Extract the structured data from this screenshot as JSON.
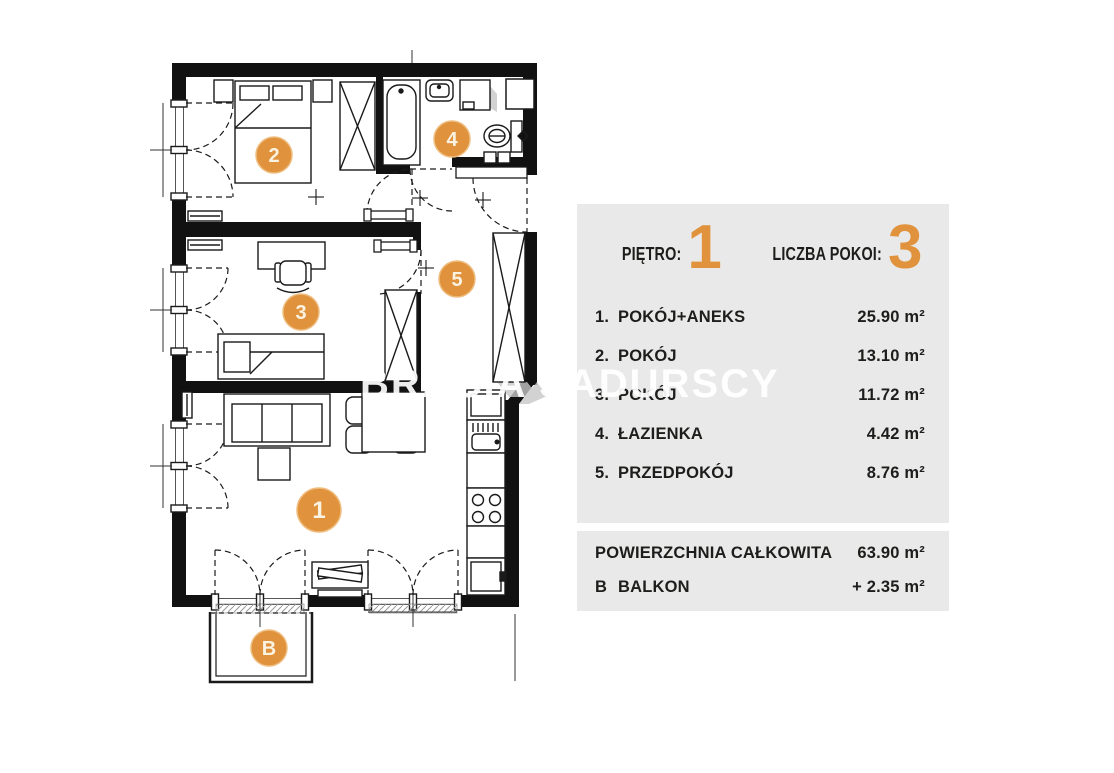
{
  "accent": "#e0923c",
  "panel_bg": "#e9e9e9",
  "watermark": "BRACIA SADURSCY",
  "header": {
    "floor_label": "PIĘTRO:",
    "floor_value": "1",
    "rooms_label": "LICZBA POKOI:",
    "rooms_value": "3"
  },
  "rooms": [
    {
      "num": "1.",
      "name": "POKÓJ+ANEKS",
      "area": "25.90 m²"
    },
    {
      "num": "2.",
      "name": "POKÓJ",
      "area": "13.10 m²"
    },
    {
      "num": "3.",
      "name": "POKÓJ",
      "area": "11.72 m²"
    },
    {
      "num": "4.",
      "name": "ŁAZIENKA",
      "area": "4.42 m²"
    },
    {
      "num": "5.",
      "name": "PRZEDPOKÓJ",
      "area": "8.76 m²"
    }
  ],
  "summary": {
    "total_label": "POWIERZCHNIA CAŁKOWITA",
    "total_value": "63.90 m²",
    "balcony_prefix": "B",
    "balcony_label": "BALKON",
    "balcony_value": "+  2.35 m²"
  },
  "plan": {
    "badges": [
      {
        "label": "1"
      },
      {
        "label": "2"
      },
      {
        "label": "3"
      },
      {
        "label": "4"
      },
      {
        "label": "5"
      },
      {
        "label": "B"
      }
    ]
  }
}
